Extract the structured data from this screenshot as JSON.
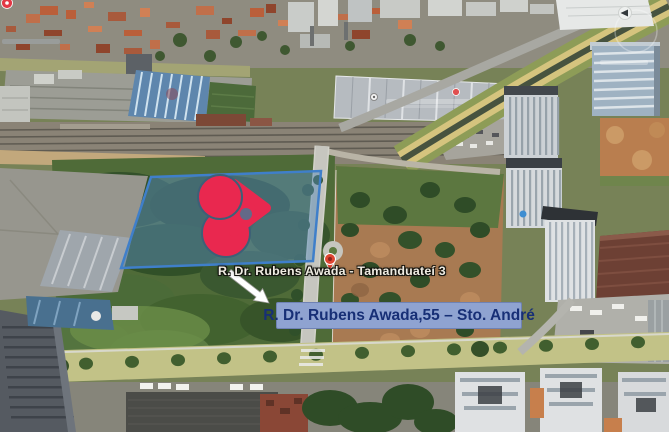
{
  "map": {
    "place_label": "R. Dr. Rubens Awada - Tamanduateí 3",
    "address_banner": "R. Dr. Rubens Awada,55 – Sto. André"
  },
  "colors": {
    "plot_fill": "#5a8cb9",
    "plot_border": "#3f7fca",
    "logo": "#e9284f",
    "banner_bg": "#8fa3d1",
    "banner_text": "#172f76",
    "label_text": "#efece2",
    "pin_red": "#df4632",
    "arrow": "#ffffff"
  },
  "icons": {
    "corner_pin": "map-pin",
    "warehouse_pin_white": "map-pin",
    "warehouse_pin_red": "map-pin",
    "road_pin": "map-pin",
    "compass": "compass-ring",
    "annotation_arrow": "arrow-down-right"
  }
}
